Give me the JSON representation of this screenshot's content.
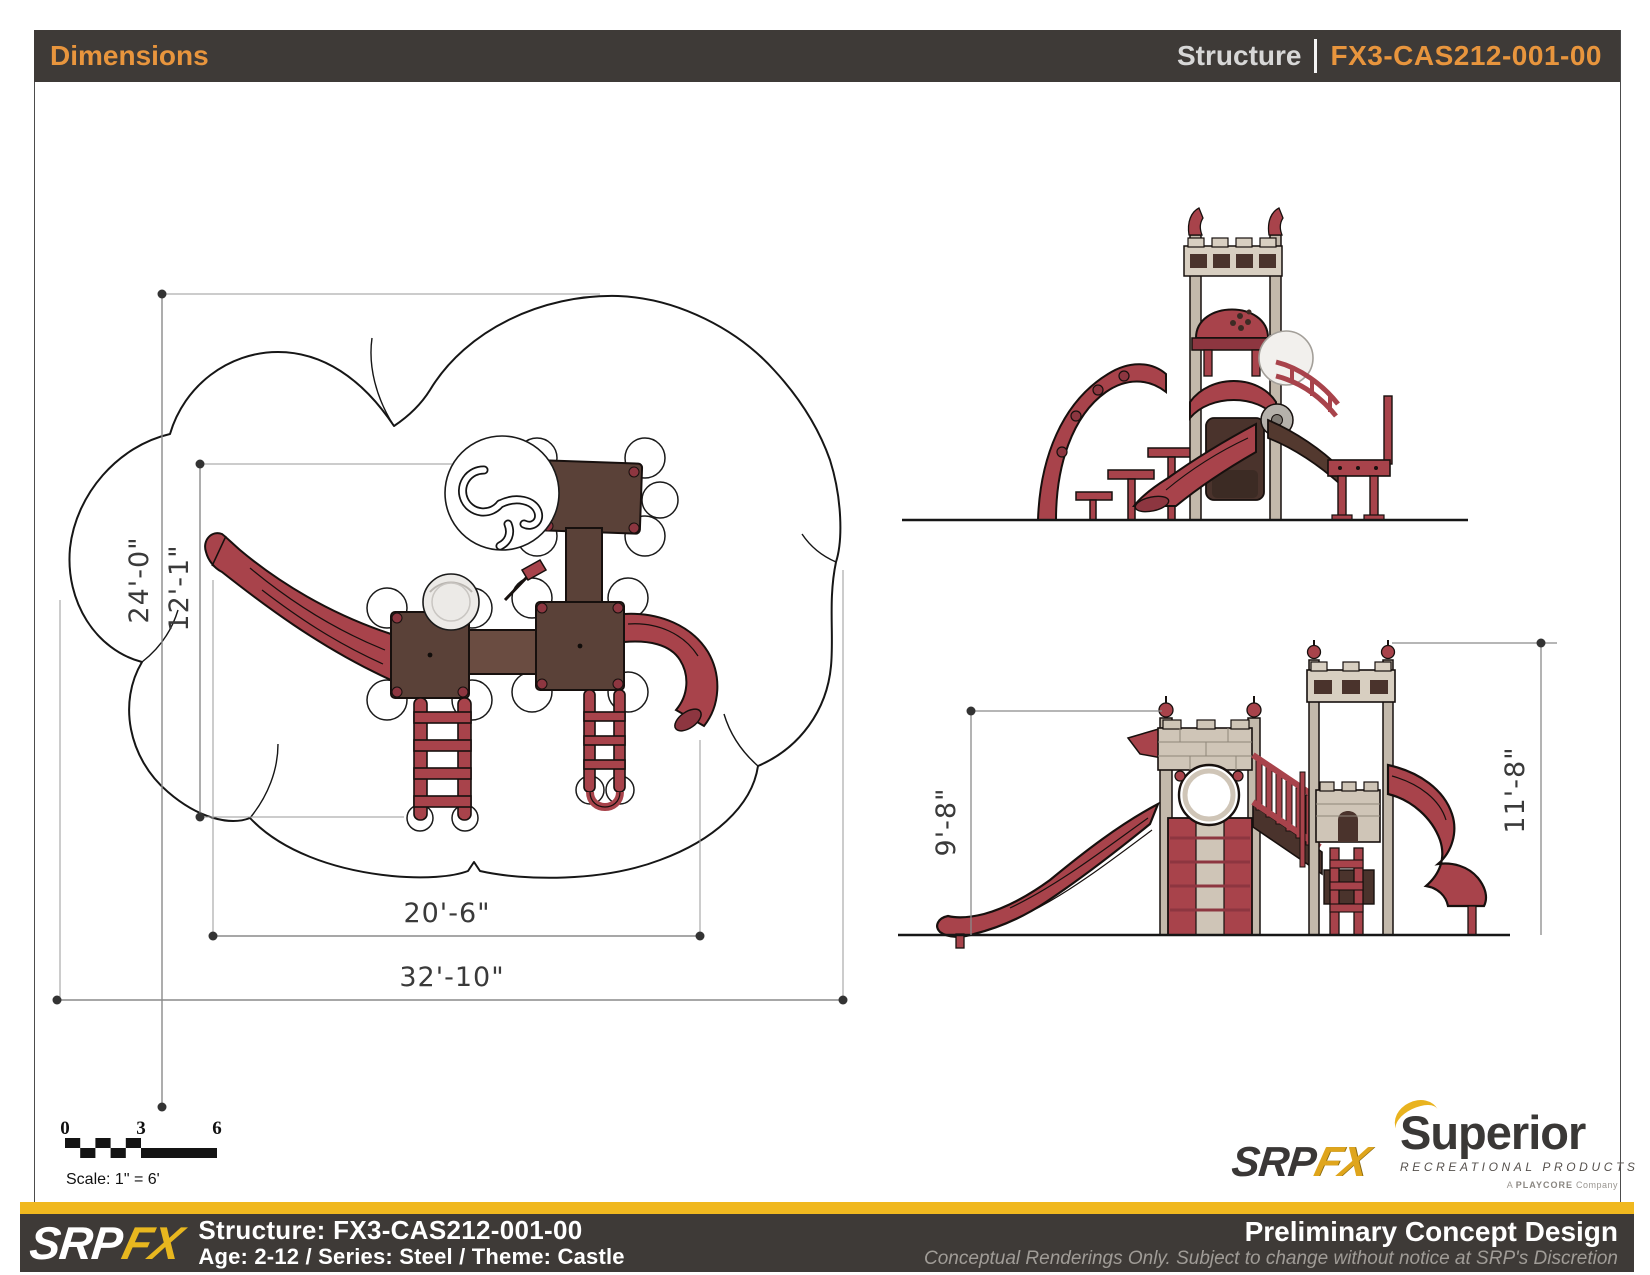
{
  "header": {
    "title": "Dimensions",
    "structure_label": "Structure",
    "structure_code": "FX3-CAS212-001-00"
  },
  "plan": {
    "dim_height_outer": "24'-0\"",
    "dim_height_inner": "12'-1\"",
    "dim_width_inner": "20'-6\"",
    "dim_width_outer": "32'-10\""
  },
  "elevation": {
    "dim_left_height": "9'-8\"",
    "dim_right_height": "11'-8\""
  },
  "scale_bar": {
    "tick_start": "0",
    "tick_mid": "3",
    "tick_end": "6",
    "label": "Scale: 1\" = 6'"
  },
  "logos": {
    "srp": "SRP",
    "fx": "FX",
    "superior": "Superior",
    "superior_sub": "RECREATIONAL PRODUCTS",
    "playcore_prefix": "A",
    "playcore_name": "PLAYCORE",
    "playcore_suffix": "Company"
  },
  "footer": {
    "structure_line": "Structure: FX3-CAS212-001-00",
    "age_series_line": "Age: 2-12 / Series: Steel / Theme: Castle",
    "title": "Preliminary Concept Design",
    "disclaimer": "Conceptual Renderings Only. Subject to change without notice at SRP's Discretion"
  },
  "colors": {
    "accent_orange": "#e8953d",
    "brand_gold": "#f0b81f",
    "play_red": "#a8434b",
    "deck_brown": "#5a4138",
    "castle_tan": "#c9bfb1",
    "header_dark": "#3e3a37"
  }
}
